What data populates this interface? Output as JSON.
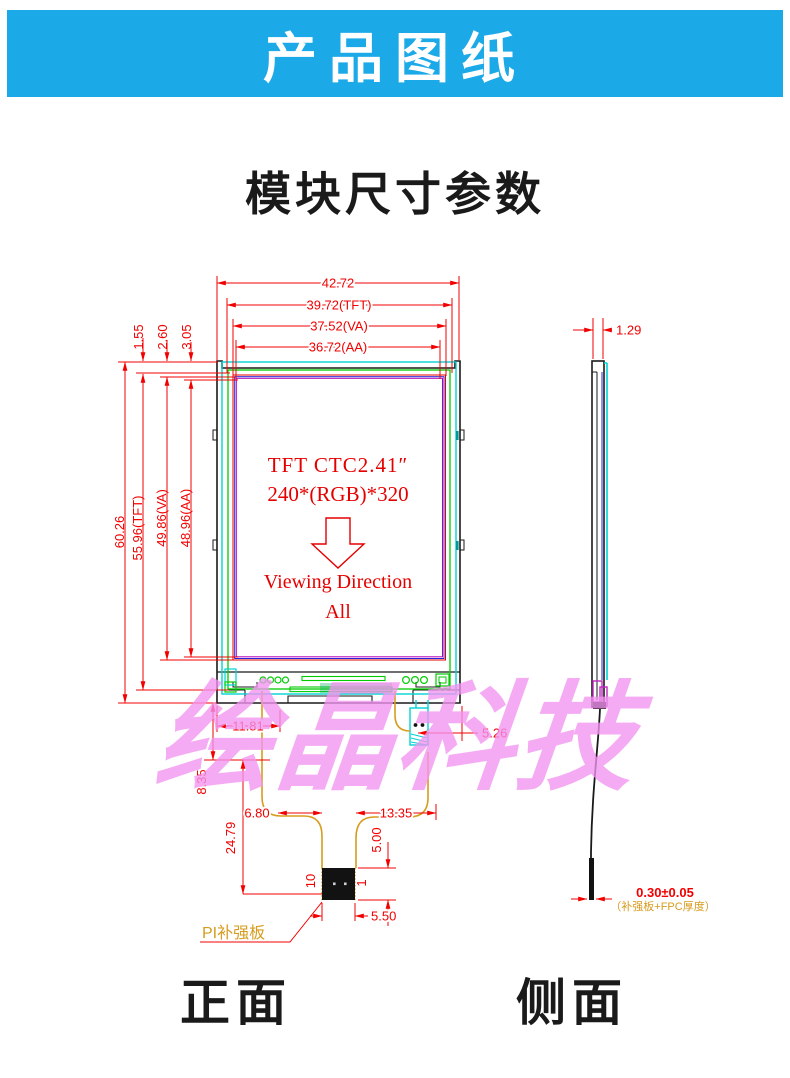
{
  "header": {
    "title": "产品图纸",
    "bg_color": "#1BA9E8"
  },
  "section": {
    "title": "模块尺寸参数"
  },
  "watermark": {
    "text": "绘晶科技",
    "color": "#F294F0"
  },
  "front_view": {
    "caption": "正面",
    "display": {
      "line1": "TFT CTC2.41″",
      "line2": "240*(RGB)*320",
      "line3": "Viewing Direction",
      "line4": "All"
    },
    "dims": {
      "width_outline": "42.72",
      "width_tft": "39.72(TFT)",
      "width_va": "37.52(VA)",
      "width_aa": "36.72(AA)",
      "top_gap_tft": "1.55",
      "top_gap_va": "2.60",
      "top_gap_aa": "3.05",
      "height_outline": "60.26",
      "height_tft": "55.96(TFT)",
      "height_va": "49.86(VA)",
      "height_aa": "48.96(AA)",
      "bottom_left": "11.81",
      "connector_offset": "5.26",
      "fpc_fold": "8.35",
      "fpc_length": "24.79",
      "neck_left": "6.80",
      "neck_right": "13.35",
      "stiffener_height": "5.00",
      "stiffener_width": "5.50",
      "pin_last": "10",
      "pin_first": "1"
    },
    "stiffener_label": "PI补强板"
  },
  "side_view": {
    "caption": "侧面",
    "dims": {
      "thickness": "1.29",
      "fpc_thickness": "0.30±0.05",
      "fpc_thickness_note": "（补强板+FPC厚度）"
    }
  },
  "colors": {
    "dimension_red": "#F20000",
    "outline_black": "#1a1a1a",
    "glass_cyan": "#00D2D2",
    "tft_green": "#00CC00",
    "va_blue": "#2424DE",
    "aa_purple": "#B400B4",
    "fpc_orange": "#D79C1E",
    "green_dim": "#00B300"
  }
}
